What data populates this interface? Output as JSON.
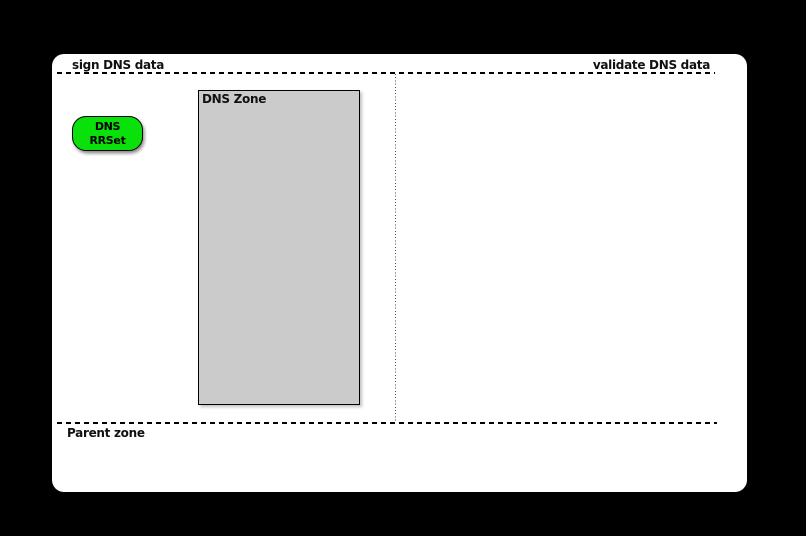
{
  "scene": {
    "background_color": "#000000",
    "panel_color": "#ffffff",
    "divider_color": "#000000"
  },
  "labels": {
    "sign": "sign DNS data",
    "validate": "validate DNS data",
    "parent_zone": "Parent zone"
  },
  "zone_box": {
    "title": "DNS Zone",
    "fill_color": "#cbcbcb",
    "border_color": "#000000"
  },
  "rrset_node": {
    "line1": "DNS",
    "line2": "RRSet",
    "fill_color": "#0ae00a",
    "border_color": "#000000"
  }
}
